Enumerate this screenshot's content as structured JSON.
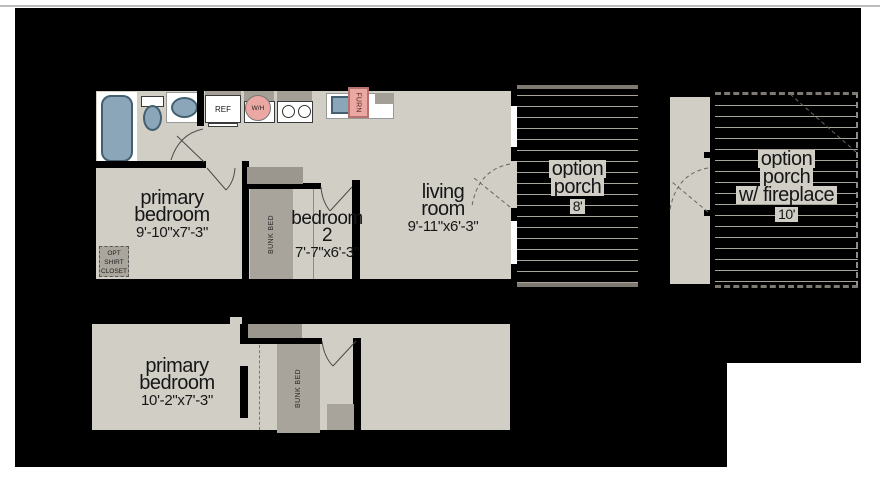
{
  "plan_title": "floor plan",
  "rooms": {
    "primary_top": {
      "line1": "primary",
      "line2": "bedroom",
      "dims": "9'-10\"x7'-3\""
    },
    "bedroom2": {
      "line1": "bedroom",
      "line2": "2",
      "dims": "7'-7\"x6'-3\""
    },
    "living": {
      "line1": "living",
      "line2": "room",
      "dims": "9'-11\"x6'-3\""
    },
    "primary_lower": {
      "line1": "primary",
      "line2": "bedroom",
      "dims": "10'-2\"x7'-3\""
    }
  },
  "porches": {
    "option": {
      "line1": "option",
      "line2": "porch",
      "dims": "8'"
    },
    "fireplace": {
      "line1": "option",
      "line2": "porch",
      "line3": "w/ fireplace",
      "dims": "10'"
    }
  },
  "fixtures": {
    "ref": "REF",
    "water_heater": "W/H",
    "furnace": "FURN",
    "bunk_bed": "BUNK BED",
    "closet": {
      "line1": "OPT",
      "line2": "SHIRT",
      "line3": "CLOSET"
    }
  },
  "colors": {
    "page_white": "#ffffff",
    "background_black": "#000000",
    "floor_beige": "#d1cec6",
    "deck_line_gray": "#a8a49a",
    "cabinet_gray": "#a39e96",
    "header_gray": "#9b968e",
    "bunk_gray": "#a8a39b",
    "fixture_blue": "#8ba6b9",
    "fixture_outline": "#42606f",
    "accent_pink": "#eba7a2",
    "accent_pink_outline": "#b4736e"
  }
}
